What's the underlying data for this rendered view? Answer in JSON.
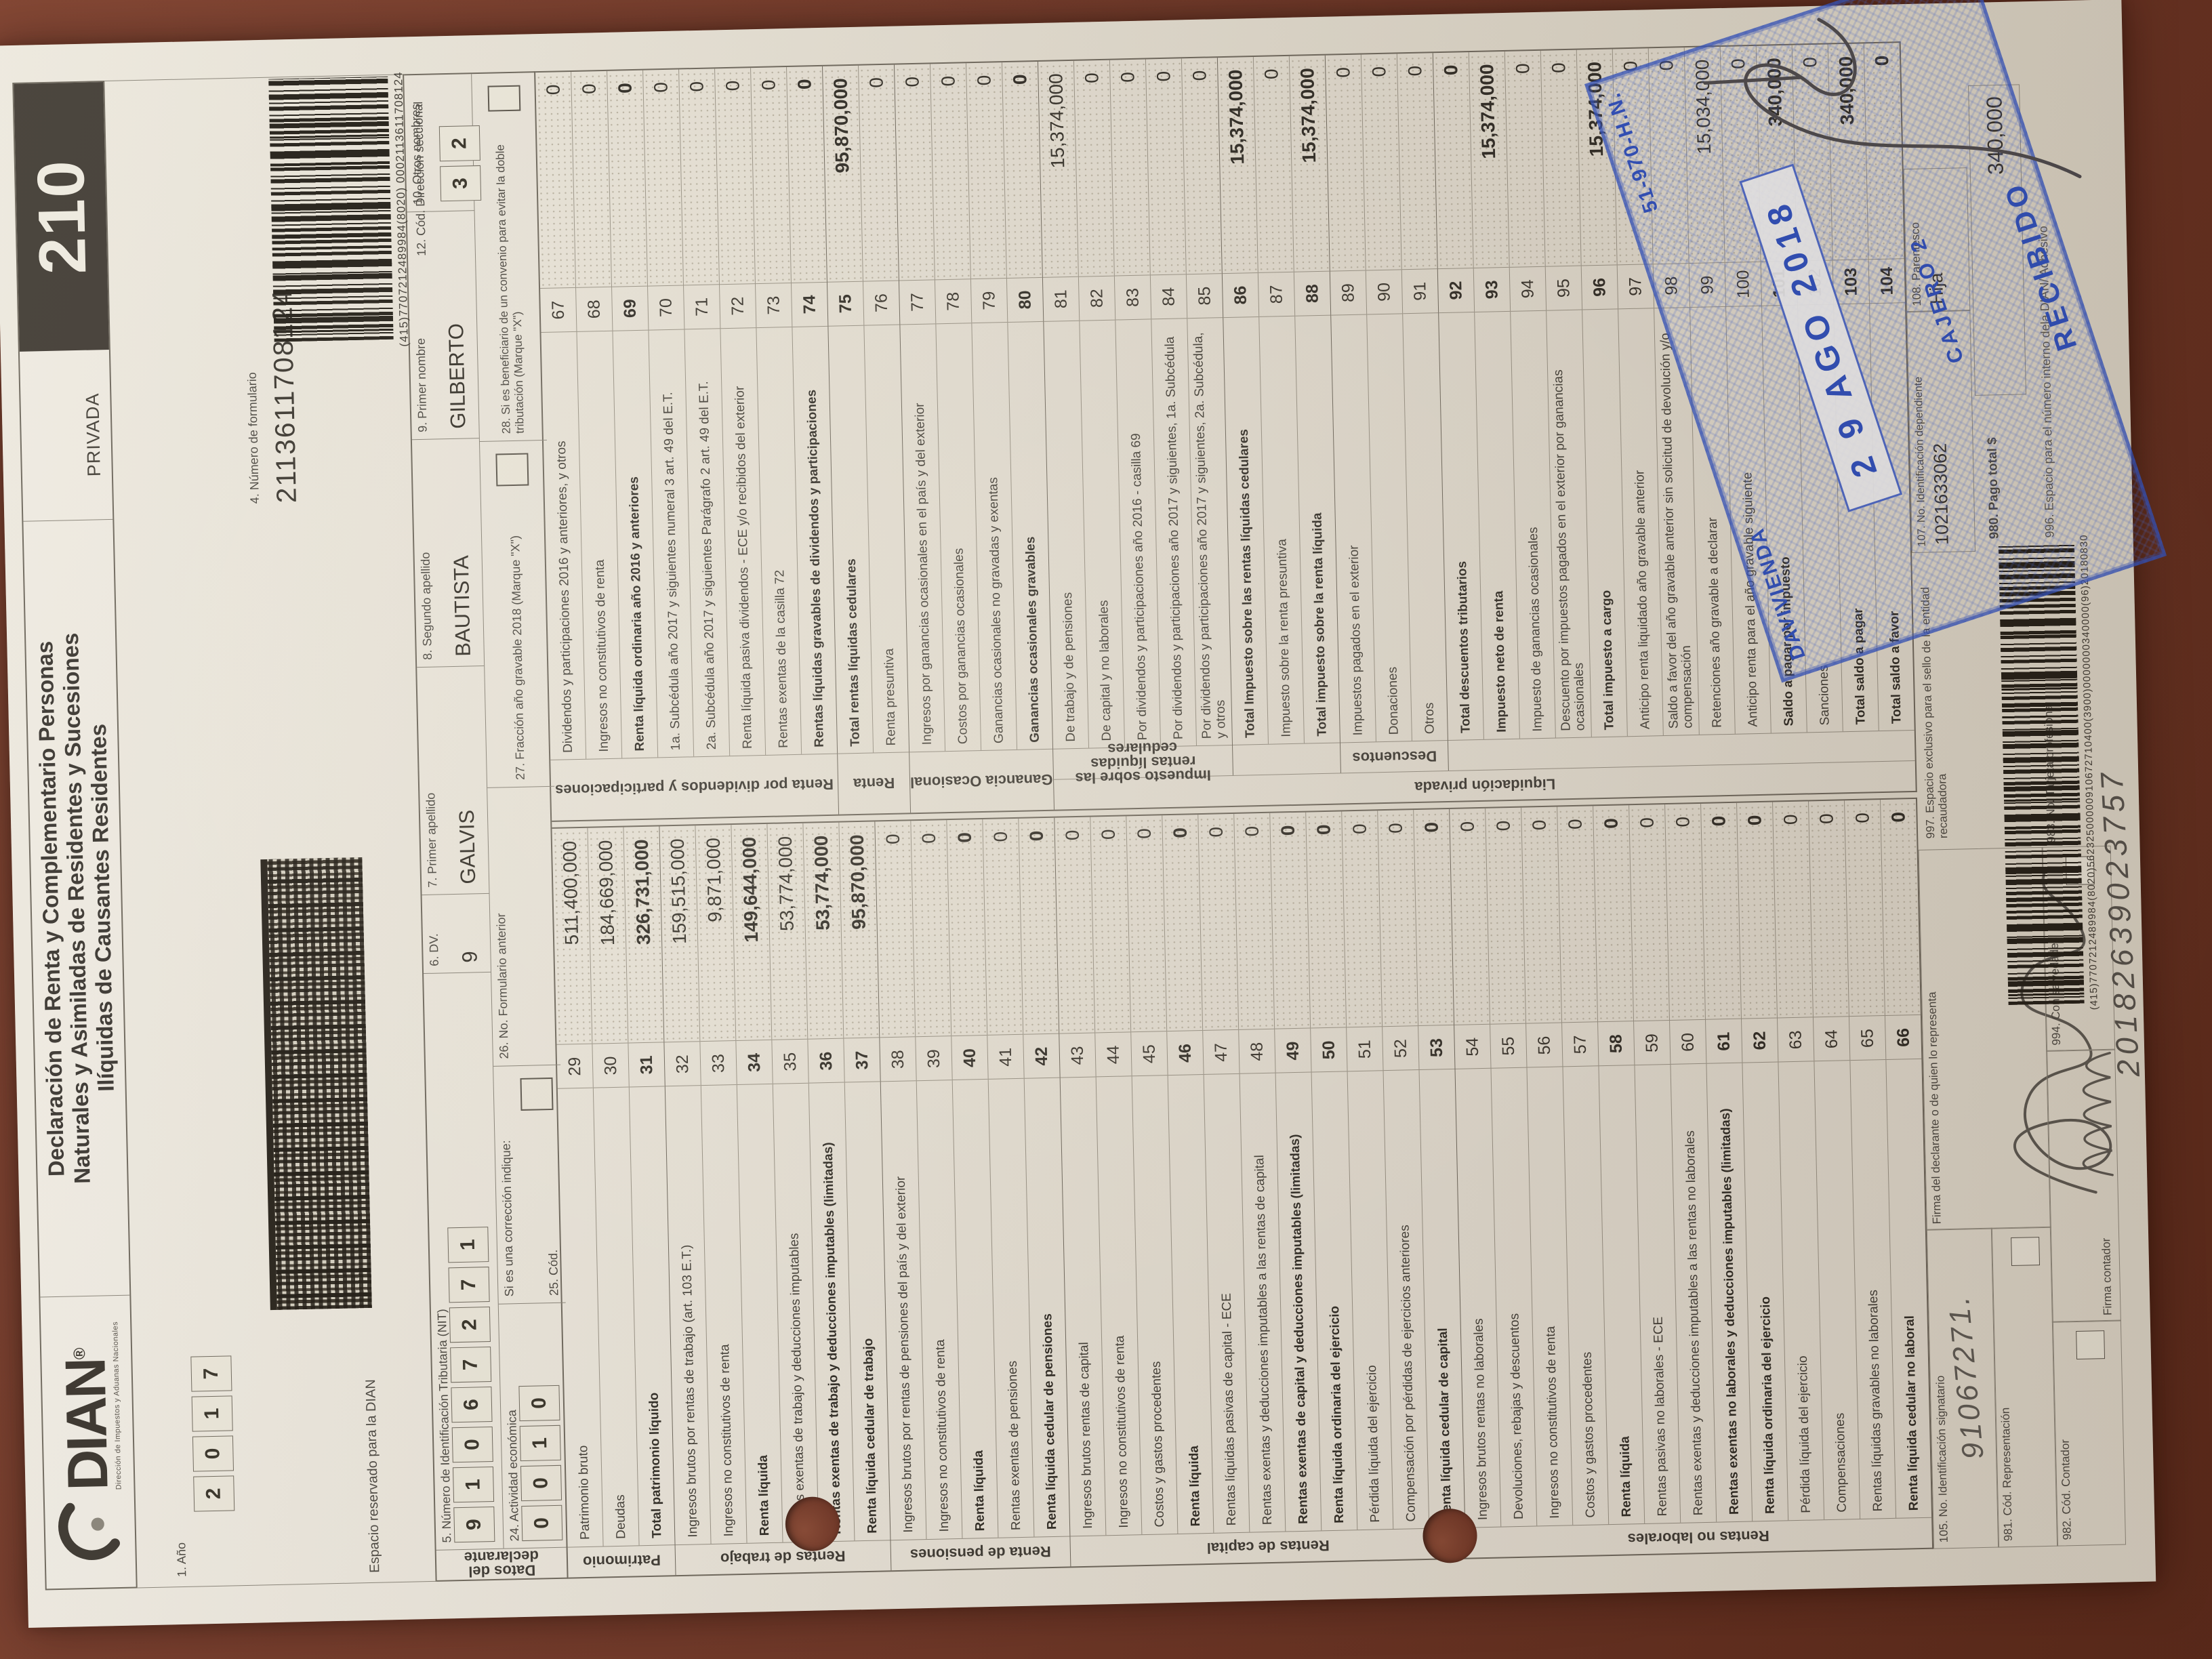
{
  "colors": {
    "surface_brown": "#6f3526",
    "stamp_blue": "#2d51c4",
    "code_box_black": "#423d37",
    "paper": "#e9e5da"
  },
  "header": {
    "form_code": "210",
    "privada": "PRIVADA",
    "title1": "Declaración de Renta y Complementario Personas",
    "title2": "Naturales y Asimiladas de Residentes y Sucesiones",
    "title3": "Ilíquidas de Causantes Residentes",
    "logo_text": "DIAN",
    "logo_mark": "®",
    "logo_sub": "Dirección de Impuestos y Aduanas Nacionales",
    "year_label": "1. Año",
    "year_digits": [
      "2",
      "0",
      "1",
      "7"
    ],
    "reserved": "Espacio reservado para la DIAN",
    "formnum_label": "4. Número de formulario",
    "formnum_value": "2113611708124",
    "top_barcode_text": "(415)7707212489984(8020) 0002113611708124",
    "seccional_label": "12. Cód. Dirección seccional",
    "seccional_digits": [
      "3",
      "2"
    ]
  },
  "declarant": {
    "strip": "Datos del declarante",
    "nit_label": "5. Número de Identificación Tributaria (NIT)",
    "nit_digits": [
      "9",
      "1",
      "0",
      "6",
      "7",
      "2",
      "7",
      "1"
    ],
    "dv_label": "6. DV.",
    "dv_value": "9",
    "ap1_label": "7. Primer apellido",
    "ap1_value": "GALVIS",
    "ap2_label": "8. Segundo apellido",
    "ap2_value": "BAUTISTA",
    "nom_label": "9. Primer nombre",
    "nom_value": "GILBERTO",
    "otros_label": "10. Otros nombres",
    "otros_value": "",
    "act_label": "24. Actividad económica",
    "act_digits": [
      "0",
      "0",
      "1",
      "0"
    ],
    "corr_label": "Si es una corrección indique:",
    "cod25_label": "25. Cód.",
    "form26_label": "26. No. Formulario anterior",
    "form26_value": "",
    "frac27_label": "27. Fracción año gravable 2018 (Marque \"X\")",
    "conv28_label": "28. Si es beneficiario de un convenio para evitar la doble tributación (Marque \"X\")"
  },
  "left_groups": [
    {
      "section": "Patrimonio",
      "rows": [
        {
          "n": "29",
          "l": "Patrimonio bruto",
          "v": "511,400,000",
          "b": false
        },
        {
          "n": "30",
          "l": "Deudas",
          "v": "184,669,000",
          "b": false
        },
        {
          "n": "31",
          "l": "Total patrimonio líquido",
          "v": "326,731,000",
          "b": true
        }
      ]
    },
    {
      "section": "Rentas de trabajo",
      "rows": [
        {
          "n": "32",
          "l": "Ingresos brutos por rentas de trabajo (art. 103 E.T.)",
          "v": "159,515,000",
          "b": false
        },
        {
          "n": "33",
          "l": "Ingresos no constitutivos de renta",
          "v": "9,871,000",
          "b": false
        },
        {
          "n": "34",
          "l": "Renta líquida",
          "v": "149,644,000",
          "b": true
        },
        {
          "n": "35",
          "l": "Rentas exentas de trabajo y deducciones imputables",
          "v": "53,774,000",
          "b": false
        },
        {
          "n": "36",
          "l": "Rentas exentas de trabajo y deducciones imputables (limitadas)",
          "v": "53,774,000",
          "b": true
        },
        {
          "n": "37",
          "l": "Renta líquida cedular de trabajo",
          "v": "95,870,000",
          "b": true
        }
      ]
    },
    {
      "section": "Renta de pensiones",
      "rows": [
        {
          "n": "38",
          "l": "Ingresos brutos por rentas de pensiones del país y del exterior",
          "v": "0",
          "b": false
        },
        {
          "n": "39",
          "l": "Ingresos no constitutivos de renta",
          "v": "0",
          "b": false
        },
        {
          "n": "40",
          "l": "Renta líquida",
          "v": "0",
          "b": true
        },
        {
          "n": "41",
          "l": "Rentas exentas de pensiones",
          "v": "0",
          "b": false
        },
        {
          "n": "42",
          "l": "Renta líquida cedular de pensiones",
          "v": "0",
          "b": true
        }
      ]
    },
    {
      "section": "Rentas de capital",
      "rows": [
        {
          "n": "43",
          "l": "Ingresos brutos rentas de capital",
          "v": "0",
          "b": false
        },
        {
          "n": "44",
          "l": "Ingresos no constitutivos de renta",
          "v": "0",
          "b": false
        },
        {
          "n": "45",
          "l": "Costos y gastos procedentes",
          "v": "0",
          "b": false
        },
        {
          "n": "46",
          "l": "Renta líquida",
          "v": "0",
          "b": true
        },
        {
          "n": "47",
          "l": "Rentas líquidas pasivas de capital - ECE",
          "v": "0",
          "b": false
        },
        {
          "n": "48",
          "l": "Rentas exentas y deducciones imputables a las rentas de capital",
          "v": "0",
          "b": false
        },
        {
          "n": "49",
          "l": "Rentas exentas de capital y deducciones imputables (limitadas)",
          "v": "0",
          "b": true
        },
        {
          "n": "50",
          "l": "Renta líquida ordinaria del ejercicio",
          "v": "0",
          "b": true
        },
        {
          "n": "51",
          "l": "Pérdida líquida del ejercicio",
          "v": "0",
          "b": false
        },
        {
          "n": "52",
          "l": "Compensación por pérdidas de ejercicios anteriores",
          "v": "0",
          "b": false
        },
        {
          "n": "53",
          "l": "Renta líquida cedular de capital",
          "v": "0",
          "b": true
        }
      ]
    },
    {
      "section": "Rentas no laborales",
      "rows": [
        {
          "n": "54",
          "l": "Ingresos brutos rentas no laborales",
          "v": "0",
          "b": false
        },
        {
          "n": "55",
          "l": "Devoluciones, rebajas y descuentos",
          "v": "0",
          "b": false
        },
        {
          "n": "56",
          "l": "Ingresos no constitutivos de renta",
          "v": "0",
          "b": false
        },
        {
          "n": "57",
          "l": "Costos y gastos procedentes",
          "v": "0",
          "b": false
        },
        {
          "n": "58",
          "l": "Renta líquida",
          "v": "0",
          "b": true
        },
        {
          "n": "59",
          "l": "Rentas pasivas no laborales - ECE",
          "v": "0",
          "b": false
        },
        {
          "n": "60",
          "l": "Rentas exentas y deducciones imputables a las rentas no laborales",
          "v": "0",
          "b": false
        },
        {
          "n": "61",
          "l": "Rentas exentas no laborales y deducciones imputables (limitadas)",
          "v": "0",
          "b": true
        },
        {
          "n": "62",
          "l": "Renta líquida ordinaria del ejercicio",
          "v": "0",
          "b": true
        },
        {
          "n": "63",
          "l": "Pérdida líquida del ejercicio",
          "v": "0",
          "b": false
        },
        {
          "n": "64",
          "l": "Compensaciones",
          "v": "0",
          "b": false
        },
        {
          "n": "65",
          "l": "Rentas líquidas gravables no laborales",
          "v": "0",
          "b": false
        },
        {
          "n": "66",
          "l": "Renta líquida cedular no laboral",
          "v": "0",
          "b": true
        }
      ]
    }
  ],
  "right_groups": [
    {
      "section": "Renta por dividendos y participaciones",
      "rows": [
        {
          "n": "67",
          "l": "Dividendos y participaciones 2016 y anteriores, y otros",
          "v": "0",
          "b": false
        },
        {
          "n": "68",
          "l": "Ingresos no constitutivos de renta",
          "v": "0",
          "b": false
        },
        {
          "n": "69",
          "l": "Renta líquida ordinaria año 2016 y anteriores",
          "v": "0",
          "b": true
        },
        {
          "n": "70",
          "l": "1a. Subcédula año 2017 y siguientes numeral 3 art. 49 del E.T.",
          "v": "0",
          "b": false
        },
        {
          "n": "71",
          "l": "2a. Subcédula año 2017 y siguientes Parágrafo 2 art. 49 del E.T.",
          "v": "0",
          "b": false
        },
        {
          "n": "72",
          "l": "Renta líquida pasiva dividendos - ECE y/o recibidos del exterior",
          "v": "0",
          "b": false
        },
        {
          "n": "73",
          "l": "Rentas exentas de la casilla 72",
          "v": "0",
          "b": false
        },
        {
          "n": "74",
          "l": "Rentas líquidas gravables de dividendos y participaciones",
          "v": "0",
          "b": true
        }
      ]
    },
    {
      "section": "Renta",
      "rows": [
        {
          "n": "75",
          "l": "Total rentas líquidas cedulares",
          "v": "95,870,000",
          "b": true
        },
        {
          "n": "76",
          "l": "Renta presuntiva",
          "v": "0",
          "b": false
        }
      ]
    },
    {
      "section": "Ganancia Ocasional",
      "rows": [
        {
          "n": "77",
          "l": "Ingresos por ganancias ocasionales en el país y del exterior",
          "v": "0",
          "b": false
        },
        {
          "n": "78",
          "l": "Costos por ganancias ocasionales",
          "v": "0",
          "b": false
        },
        {
          "n": "79",
          "l": "Ganancias ocasionales no gravadas y exentas",
          "v": "0",
          "b": false
        },
        {
          "n": "80",
          "l": "Ganancias ocasionales gravables",
          "v": "0",
          "b": true
        }
      ]
    }
  ],
  "right_outer": "Liquidación privada",
  "right_sub": [
    {
      "section": "Impuesto sobre las rentas líquidas cedulares",
      "rows": [
        {
          "n": "81",
          "l": "De trabajo y de pensiones",
          "v": "15,374,000",
          "b": false
        },
        {
          "n": "82",
          "l": "De capital y no laborales",
          "v": "0",
          "b": false
        },
        {
          "n": "83",
          "l": "Por dividendos y participaciones año 2016 - casilla 69",
          "v": "0",
          "b": false
        },
        {
          "n": "84",
          "l": "Por dividendos y participaciones año 2017 y siguientes, 1a. Subcédula",
          "v": "0",
          "b": false
        },
        {
          "n": "85",
          "l": "Por dividendos y participaciones año 2017 y siguientes, 2a. Subcédula, y otros",
          "v": "0",
          "b": false
        }
      ]
    },
    {
      "section": "",
      "rows": [
        {
          "n": "86",
          "l": "Total Impuesto sobre las rentas líquidas cedulares",
          "v": "15,374,000",
          "b": true
        },
        {
          "n": "87",
          "l": "Impuesto sobre la renta presuntiva",
          "v": "0",
          "b": false
        },
        {
          "n": "88",
          "l": "Total impuesto sobre la renta líquida",
          "v": "15,374,000",
          "b": true
        }
      ]
    },
    {
      "section": "Descuentos",
      "rows": [
        {
          "n": "89",
          "l": "Impuestos pagados en el exterior",
          "v": "0",
          "b": false
        },
        {
          "n": "90",
          "l": "Donaciones",
          "v": "0",
          "b": false
        },
        {
          "n": "91",
          "l": "Otros",
          "v": "0",
          "b": false
        }
      ]
    },
    {
      "section": "",
      "rows": [
        {
          "n": "92",
          "l": "Total descuentos tributarios",
          "v": "0",
          "b": true
        },
        {
          "n": "93",
          "l": "Impuesto neto de renta",
          "v": "15,374,000",
          "b": true
        },
        {
          "n": "94",
          "l": "Impuesto de ganancias ocasionales",
          "v": "0",
          "b": false
        },
        {
          "n": "95",
          "l": "Descuento por impuestos pagados en el exterior por ganancias ocasionales",
          "v": "0",
          "b": false
        },
        {
          "n": "96",
          "l": "Total impuesto a cargo",
          "v": "15,374,000",
          "b": true
        },
        {
          "n": "97",
          "l": "Anticipo renta liquidado año gravable anterior",
          "v": "0",
          "b": false
        },
        {
          "n": "98",
          "l": "Saldo a favor del año gravable anterior sin solicitud de devolución y/o compensación",
          "v": "0",
          "b": false
        },
        {
          "n": "99",
          "l": "Retenciones año gravable a declarar",
          "v": "15,034,000",
          "b": false
        },
        {
          "n": "100",
          "l": "Anticipo renta para el año gravable siguiente",
          "v": "0",
          "b": false
        },
        {
          "n": "101",
          "l": "Saldo a pagar por impuesto",
          "v": "340,000",
          "b": true
        },
        {
          "n": "102",
          "l": "Sanciones",
          "v": "0",
          "b": false
        },
        {
          "n": "103",
          "l": "Total saldo a pagar",
          "v": "340,000",
          "b": true
        },
        {
          "n": "104",
          "l": "Total saldo a favor",
          "v": "0",
          "b": true
        }
      ]
    }
  ],
  "footer": {
    "f105_label": "105. No. Identificación signatario",
    "f981_label": "981. Cód. Representación",
    "firma_decl_label": "Firma del declarante o de quien lo representa",
    "f997_label": "997. Espacio exclusivo para el sello de la entidad recaudadora",
    "f107_label": "107. No. Identificación dependiente",
    "f107_value": "1021633062",
    "f108_label": "108. Parentesco",
    "f108_value": "Hija",
    "f980_label": "980. Pago total $",
    "f980_value": "340,000",
    "f996_label": "996. Espacio para el número interno dela DIAN/ Adhesivo",
    "f982_label": "982. Cód. Contador",
    "firma_cont_label": "Firma contador",
    "f994_label": "994. Con salvedades",
    "f983_label": "983. No. Tarjeta profesional",
    "bottom_barcode_text": "(415)7707212489984(8020)56232500000910672710400(3900)0000000340000(96)20180830"
  },
  "handwriting": {
    "signatory_id": "91067271.",
    "bottom_number": "20182639023757"
  },
  "stamp": {
    "bank": "DAVIVIENDA",
    "code": "51-970-H.N.",
    "date": "2 9 AGO 2018",
    "cashier": "CAJERO 2",
    "received": "RECIBIDO"
  }
}
